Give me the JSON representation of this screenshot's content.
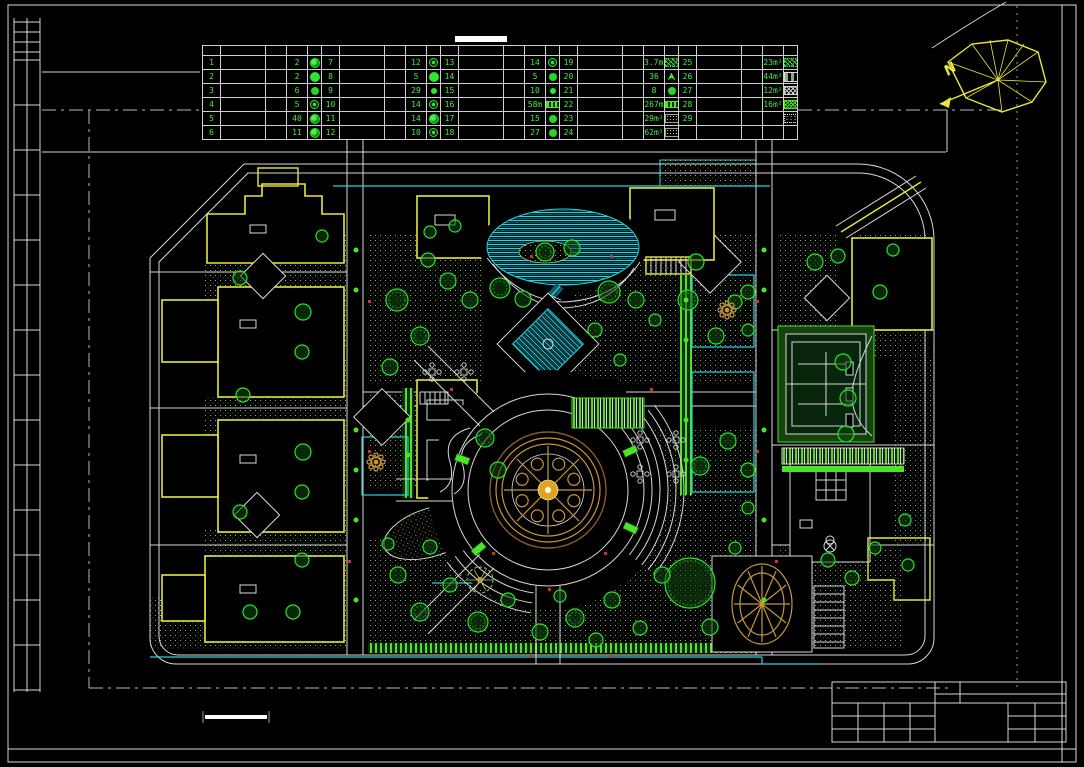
{
  "colors": {
    "background": "#000000",
    "linework": "#d8d8d8",
    "building_outline": "#e8e83a",
    "vegetation": "#2be32b",
    "water": "#2ad1de",
    "ornament_gold": "#c8963c",
    "marker_red": "#d03030"
  },
  "north_arrow": {
    "label": "N"
  },
  "legend_table": {
    "groups": [
      {
        "rows": [
          {
            "no": "1",
            "name": "",
            "spec": "",
            "qty": "2",
            "symbol": "tree-a"
          },
          {
            "no": "2",
            "name": "",
            "spec": "",
            "qty": "2",
            "symbol": "tree-b"
          },
          {
            "no": "3",
            "name": "",
            "spec": "",
            "qty": "6",
            "symbol": "tree-c"
          },
          {
            "no": "4",
            "name": "",
            "spec": "",
            "qty": "5",
            "symbol": "tree-d"
          },
          {
            "no": "5",
            "name": "",
            "spec": "",
            "qty": "40",
            "symbol": "tree-a"
          },
          {
            "no": "6",
            "name": "",
            "spec": "",
            "qty": "11",
            "symbol": "tree-a"
          }
        ]
      },
      {
        "rows": [
          {
            "no": "7",
            "name": "",
            "spec": "",
            "qty": "12",
            "symbol": "tree-d"
          },
          {
            "no": "8",
            "name": "",
            "spec": "",
            "qty": "5",
            "symbol": "tree-b"
          },
          {
            "no": "9",
            "name": "",
            "spec": "",
            "qty": "29",
            "symbol": "tree-e"
          },
          {
            "no": "10",
            "name": "",
            "spec": "",
            "qty": "14",
            "symbol": "tree-d"
          },
          {
            "no": "11",
            "name": "",
            "spec": "",
            "qty": "14",
            "symbol": "tree-a"
          },
          {
            "no": "12",
            "name": "",
            "spec": "",
            "qty": "10",
            "symbol": "tree-d"
          }
        ]
      },
      {
        "rows": [
          {
            "no": "13",
            "name": "",
            "spec": "",
            "qty": "14",
            "symbol": "tree-d"
          },
          {
            "no": "14",
            "name": "",
            "spec": "",
            "qty": "5",
            "symbol": "tree-c"
          },
          {
            "no": "15",
            "name": "",
            "spec": "",
            "qty": "10",
            "symbol": "tree-e"
          },
          {
            "no": "16",
            "name": "",
            "spec": "",
            "qty": "58m",
            "symbol": "hedge"
          },
          {
            "no": "17",
            "name": "",
            "spec": "",
            "qty": "15",
            "symbol": "tree-c"
          },
          {
            "no": "18",
            "name": "",
            "spec": "",
            "qty": "27",
            "symbol": "tree-c"
          }
        ]
      },
      {
        "rows": [
          {
            "no": "19",
            "name": "",
            "spec": "",
            "qty": "3.7m²",
            "symbol": "scatter"
          },
          {
            "no": "20",
            "name": "",
            "spec": "",
            "qty": "36",
            "symbol": "sprout"
          },
          {
            "no": "21",
            "name": "",
            "spec": "",
            "qty": "8",
            "symbol": "tree-c"
          },
          {
            "no": "22",
            "name": "",
            "spec": "",
            "qty": "267m",
            "symbol": "hedge"
          },
          {
            "no": "23",
            "name": "",
            "spec": "",
            "qty": "29m²",
            "symbol": "dots"
          },
          {
            "no": "24",
            "name": "",
            "spec": "",
            "qty": "62m²",
            "symbol": "dots"
          }
        ]
      },
      {
        "rows": [
          {
            "no": "25",
            "name": "",
            "spec": "",
            "qty": "23m²",
            "symbol": "scatter"
          },
          {
            "no": "26",
            "name": "",
            "spec": "",
            "qty": "44m²",
            "symbol": "bars"
          },
          {
            "no": "27",
            "name": "",
            "spec": "",
            "qty": "12m²",
            "symbol": "cross"
          },
          {
            "no": "28",
            "name": "",
            "spec": "",
            "qty": "16m²",
            "symbol": "fine"
          },
          {
            "no": "29",
            "name": "",
            "spec": "",
            "qty": "",
            "symbol": "brick"
          },
          {
            "no": "",
            "name": "",
            "spec": "",
            "qty": "",
            "symbol": ""
          }
        ]
      }
    ]
  }
}
